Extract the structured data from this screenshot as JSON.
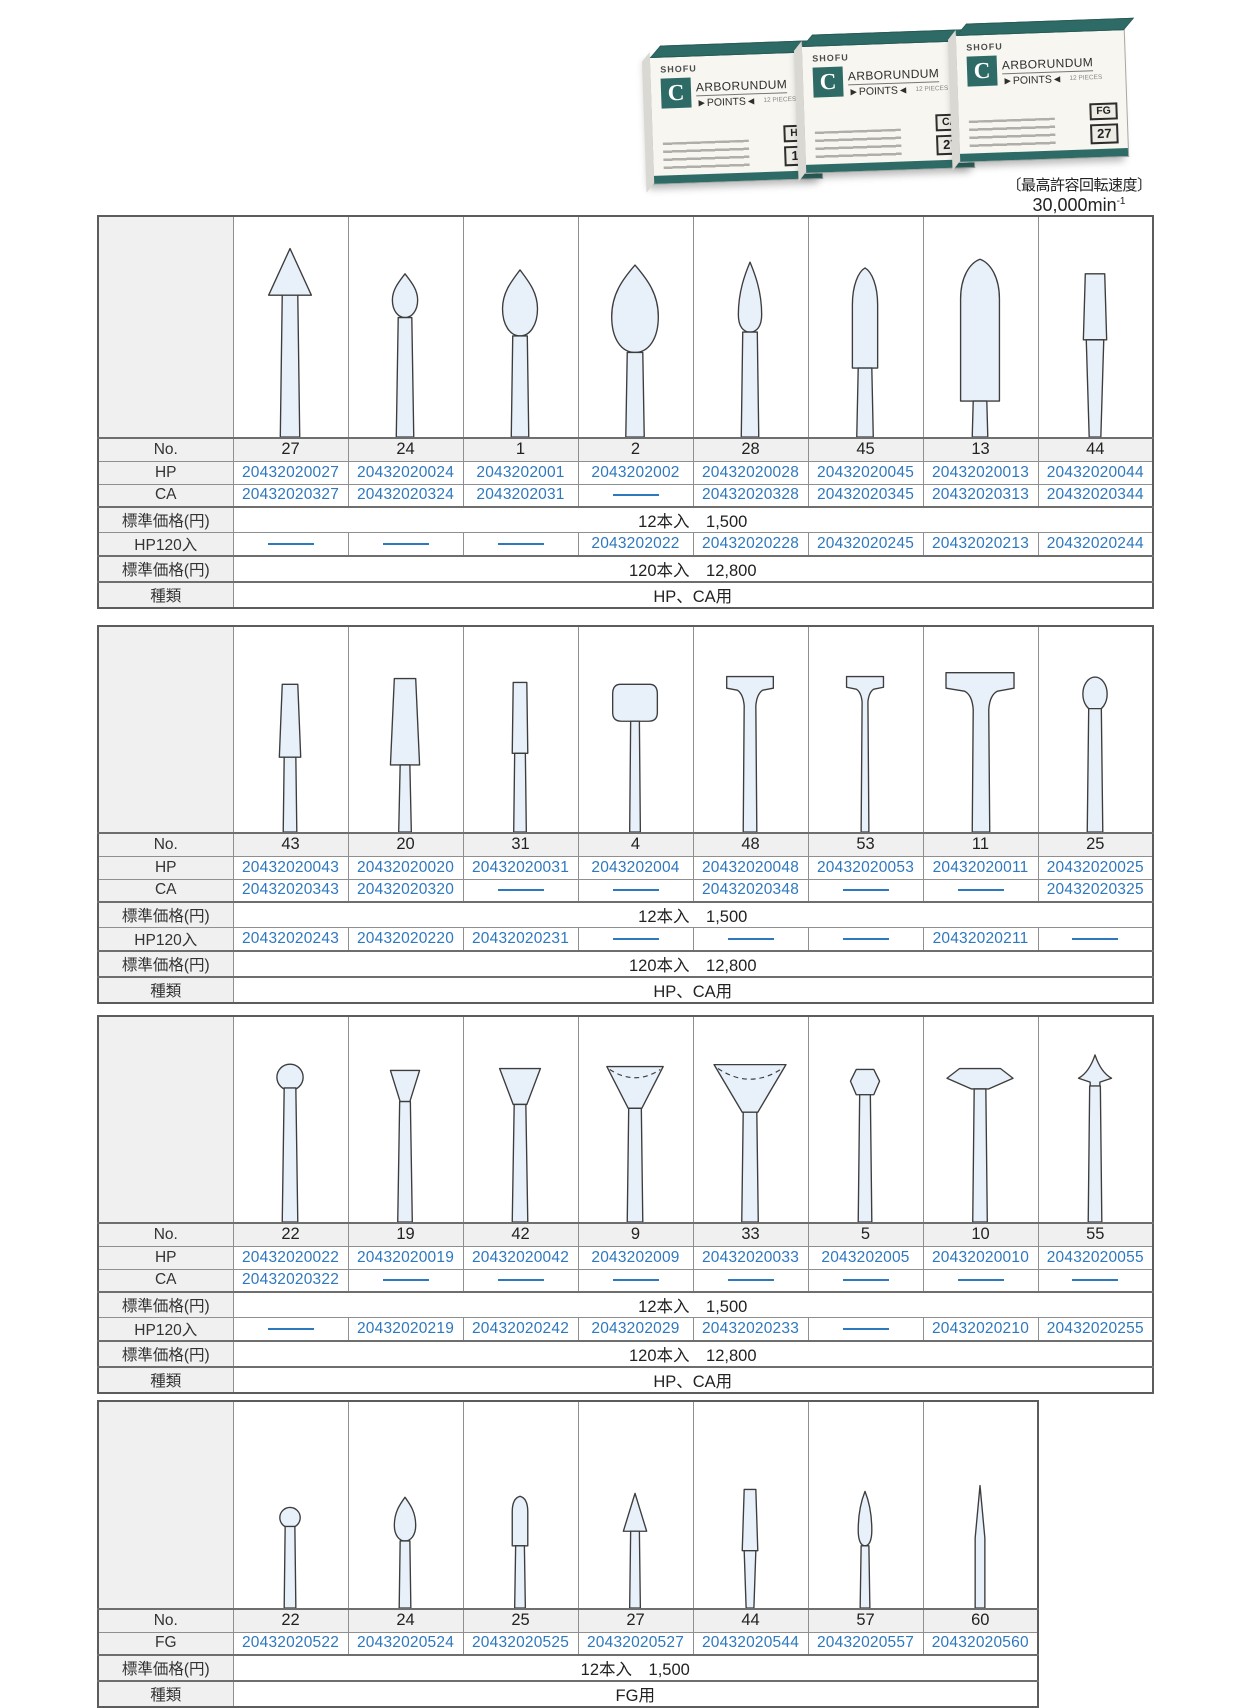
{
  "colors": {
    "accent": "#2e78be",
    "teal": "#2f6b66",
    "shape_fill": "#e8f1fa",
    "header_bg": "#f0f0f0"
  },
  "photo": {
    "brand": "SHOFU",
    "logo_letter": "C",
    "title_rest": "ARBORUNDUM",
    "subtitle": "►POINTS◄",
    "pieces": "12 PIECES",
    "boxes": [
      {
        "type_label": "HP",
        "number": "11"
      },
      {
        "type_label": "CA",
        "number": "27"
      },
      {
        "type_label": "FG",
        "number": "27"
      }
    ],
    "caption_label": "〔最高許容回転速度〕",
    "caption_value": "30,000min",
    "caption_sup": "-1"
  },
  "tables": [
    {
      "name": "hp-ca-table-1",
      "shapes": [
        "cone",
        "bud",
        "teardrop",
        "teardrop-large",
        "flame-slim",
        "bullet",
        "torpedo",
        "taper-cylinder"
      ],
      "rows": [
        {
          "label": "No.",
          "kind": "nums",
          "values": [
            "27",
            "24",
            "1",
            "2",
            "28",
            "45",
            "13",
            "44"
          ]
        },
        {
          "label": "HP",
          "kind": "codes",
          "values": [
            "20432020027",
            "20432020024",
            "2043202001",
            "2043202002",
            "20432020028",
            "20432020045",
            "20432020013",
            "20432020044"
          ]
        },
        {
          "label": "CA",
          "kind": "codes",
          "values": [
            "20432020327",
            "20432020324",
            "2043202031",
            "",
            "20432020328",
            "20432020345",
            "20432020313",
            "20432020344"
          ]
        },
        {
          "label": "標準価格(円)",
          "kind": "span",
          "value": "12本入　1,500"
        },
        {
          "label": "HP120入",
          "kind": "codes",
          "values": [
            "",
            "",
            "",
            "2043202022",
            "20432020228",
            "20432020245",
            "20432020213",
            "20432020244"
          ]
        },
        {
          "label": "標準価格(円)",
          "kind": "span",
          "value": "120本入　12,800"
        },
        {
          "label": "種類",
          "kind": "span",
          "value": "HP、CA用"
        }
      ]
    },
    {
      "name": "hp-ca-table-2",
      "shapes": [
        "taper-column",
        "taper-column-wide",
        "column-narrow",
        "knob",
        "tee-wheel",
        "tee-wheel-small",
        "tee-wheel-large",
        "egg"
      ],
      "rows": [
        {
          "label": "No.",
          "kind": "nums",
          "values": [
            "43",
            "20",
            "31",
            "4",
            "48",
            "53",
            "11",
            "25"
          ]
        },
        {
          "label": "HP",
          "kind": "codes",
          "values": [
            "20432020043",
            "20432020020",
            "20432020031",
            "2043202004",
            "20432020048",
            "20432020053",
            "20432020011",
            "20432020025"
          ]
        },
        {
          "label": "CA",
          "kind": "codes",
          "values": [
            "20432020343",
            "20432020320",
            "",
            "",
            "20432020348",
            "",
            "",
            "20432020325"
          ]
        },
        {
          "label": "標準価格(円)",
          "kind": "span",
          "value": "12本入　1,500"
        },
        {
          "label": "HP120入",
          "kind": "codes",
          "values": [
            "20432020243",
            "20432020220",
            "20432020231",
            "",
            "",
            "",
            "20432020211",
            ""
          ]
        },
        {
          "label": "標準価格(円)",
          "kind": "span",
          "value": "120本入　12,800"
        },
        {
          "label": "種類",
          "kind": "span",
          "value": "HP、CA用"
        }
      ]
    },
    {
      "name": "hp-ca-table-3",
      "shapes": [
        "ball",
        "inverted-cone-small",
        "inverted-cone",
        "cup",
        "cup-wide",
        "barrel",
        "knife-edge-wheel",
        "arrow-point"
      ],
      "rows": [
        {
          "label": "No.",
          "kind": "nums",
          "values": [
            "22",
            "19",
            "42",
            "9",
            "33",
            "5",
            "10",
            "55"
          ]
        },
        {
          "label": "HP",
          "kind": "codes",
          "values": [
            "20432020022",
            "20432020019",
            "20432020042",
            "2043202009",
            "20432020033",
            "2043202005",
            "20432020010",
            "20432020055"
          ]
        },
        {
          "label": "CA",
          "kind": "codes",
          "values": [
            "20432020322",
            "",
            "",
            "",
            "",
            "",
            "",
            ""
          ]
        },
        {
          "label": "標準価格(円)",
          "kind": "span",
          "value": "12本入　1,500"
        },
        {
          "label": "HP120入",
          "kind": "codes",
          "values": [
            "",
            "20432020219",
            "20432020242",
            "2043202029",
            "20432020233",
            "",
            "20432020210",
            "20432020255"
          ]
        },
        {
          "label": "標準価格(円)",
          "kind": "span",
          "value": "120本入　12,800"
        },
        {
          "label": "種類",
          "kind": "span",
          "value": "HP、CA用"
        }
      ]
    },
    {
      "name": "fg-table",
      "shapes": [
        "ball-small",
        "flame-small",
        "bullet-small",
        "cone-small",
        "taper-cylinder-small",
        "flame-slim-small",
        "needle"
      ],
      "rows": [
        {
          "label": "No.",
          "kind": "nums",
          "values": [
            "22",
            "24",
            "25",
            "27",
            "44",
            "57",
            "60"
          ]
        },
        {
          "label": "FG",
          "kind": "codes",
          "values": [
            "20432020522",
            "20432020524",
            "20432020525",
            "20432020527",
            "20432020544",
            "20432020557",
            "20432020560"
          ]
        },
        {
          "label": "標準価格(円)",
          "kind": "span",
          "value": "12本入　1,500"
        },
        {
          "label": "種類",
          "kind": "span",
          "value": "FG用"
        }
      ]
    }
  ]
}
